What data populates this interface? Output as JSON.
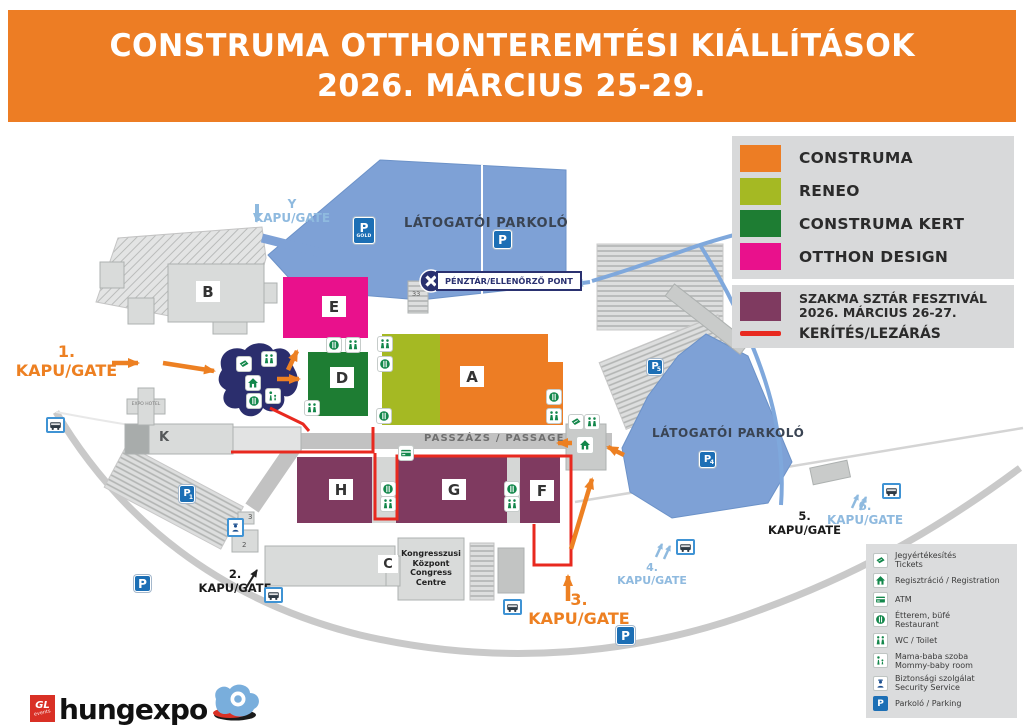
{
  "header": {
    "line1": "CONSTRUMA OTTHONTEREMTÉSI KIÁLLÍTÁSOK",
    "line2": "2026. MÁRCIUS 25-29."
  },
  "legend": {
    "items": [
      {
        "label": "CONSTRUMA",
        "color": "#ED7D24"
      },
      {
        "label": "RENEO",
        "color": "#A5B923"
      },
      {
        "label": "CONSTRUMA KERT",
        "color": "#1E7D33"
      },
      {
        "label": "OTTHON DESIGN",
        "color": "#E9118C"
      }
    ],
    "szakma": {
      "line1": "SZAKMA SZTÁR FESZTIVÁL",
      "line2": "2026. MÁRCIUS 26-27.",
      "color": "#7F3A60"
    },
    "fence": {
      "label": "KERÍTÉS/LEZÁRÁS",
      "color": "#E8291F"
    }
  },
  "facilities": {
    "rows": [
      {
        "name": "tickets",
        "line1": "Jegyértékesítés",
        "line2": "Tickets"
      },
      {
        "name": "registration",
        "line1": "Regisztráció / Registration",
        "line2": ""
      },
      {
        "name": "atm",
        "line1": "ATM",
        "line2": ""
      },
      {
        "name": "restaurant",
        "line1": "Étterem, büfé",
        "line2": "Restaurant"
      },
      {
        "name": "wc",
        "line1": "WC / Toilet",
        "line2": ""
      },
      {
        "name": "mommy-baby",
        "line1": "Mama-baba szoba",
        "line2": "Mommy-baby room"
      },
      {
        "name": "security",
        "line1": "Biztonsági szolgálat",
        "line2": "Security Service"
      },
      {
        "name": "parking",
        "line1": "Parkoló / Parking",
        "line2": ""
      }
    ]
  },
  "map": {
    "halls": {
      "a": "A",
      "b": "B",
      "c": "C",
      "d": "D",
      "e": "E",
      "f": "F",
      "g": "G",
      "h": "H",
      "k": "K"
    },
    "labels": {
      "visitor_parking": "LÁTOGATÓI PARKOLÓ",
      "passage": "PASSZÁZS / PASSAGE",
      "checkpoint": "PÉNZTÁR/ELLENŐRZŐ PONT",
      "expo_hotel": "EXPO HOTEL",
      "b33": "33",
      "b3": "3",
      "b2": "2",
      "congress": [
        "Kongresszusi",
        "Központ",
        "Congress",
        "Centre"
      ]
    },
    "gates": {
      "g1": {
        "num": "1.",
        "label": "KAPU/GATE"
      },
      "g2": {
        "num": "2.",
        "label": "KAPU/GATE"
      },
      "g3": {
        "num": "3.",
        "label": "KAPU/GATE"
      },
      "g4": {
        "num": "4.",
        "label": "KAPU/GATE"
      },
      "g5": {
        "num": "5.",
        "label": "KAPU/GATE"
      },
      "g6": {
        "num": "6.",
        "label": "KAPU/GATE"
      },
      "gy": {
        "num": "Y",
        "label": "KAPU/GATE"
      }
    },
    "parking_marks": {
      "p": "P",
      "gold": "GOLD",
      "n1": "1",
      "n4": "4",
      "n5": "5"
    }
  },
  "footer": {
    "brand": "hungexpo",
    "badge_top": "GL",
    "badge_bottom": "events"
  },
  "colors": {
    "header_orange": "#ED7D24",
    "parking_blue": "#7EA1D6",
    "p_icon_blue": "#1C6FB5",
    "entrance_navy": "#2B2E6D",
    "fence_red": "#E8291F",
    "gate_blue_text": "#8FBADF"
  }
}
